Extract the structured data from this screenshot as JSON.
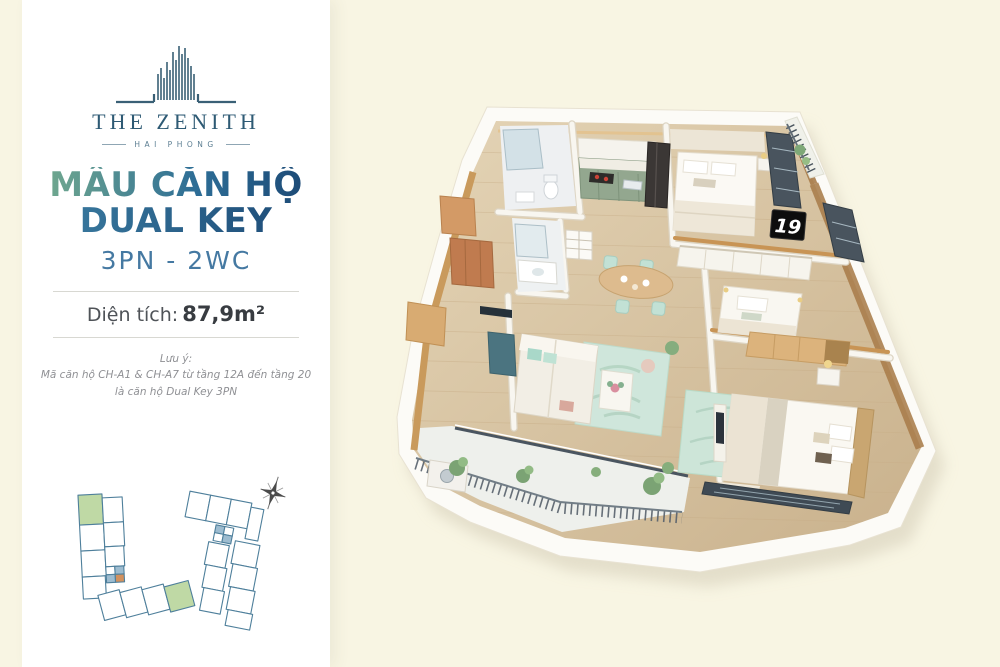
{
  "colors": {
    "page-bg": "#F8F5E3",
    "panel-bg": "#FFFFFF",
    "logo-navy": "#2E5A74",
    "grad-start": "#6FA78F",
    "grad-end": "#1D4B77",
    "config-blue": "#4579A2",
    "keyplan-green": "#BFD9A5",
    "keyplan-line": "#4E7F9B"
  },
  "brand": {
    "name": "THE ZENITH",
    "location": "HAI PHONG",
    "logo_icon": "zenith-towers-mark"
  },
  "listing": {
    "title_line1": "MẪU CĂN HỘ",
    "title_line2": "DUAL KEY",
    "config": "3PN - 2WC",
    "area_label": "Diện tích:",
    "area_value": "87,9m²",
    "note_heading": "Lưu ý:",
    "note_line1": "Mã căn hộ CH-A1 & CH-A7 từ tầng 12A đến tầng 20",
    "note_line2": "là căn hộ Dual Key 3PN"
  },
  "key_plan": {
    "highlighted_units": 2,
    "compass_icon": "compass-rose"
  },
  "floor_plan": {
    "unit_sign": "19",
    "style": "3d-isometric-render",
    "rooms": [
      "bathroom-1",
      "bathroom-2",
      "kitchen",
      "dining-area",
      "living-room",
      "bedroom-1",
      "bedroom-2",
      "master-bedroom",
      "balcony"
    ]
  }
}
